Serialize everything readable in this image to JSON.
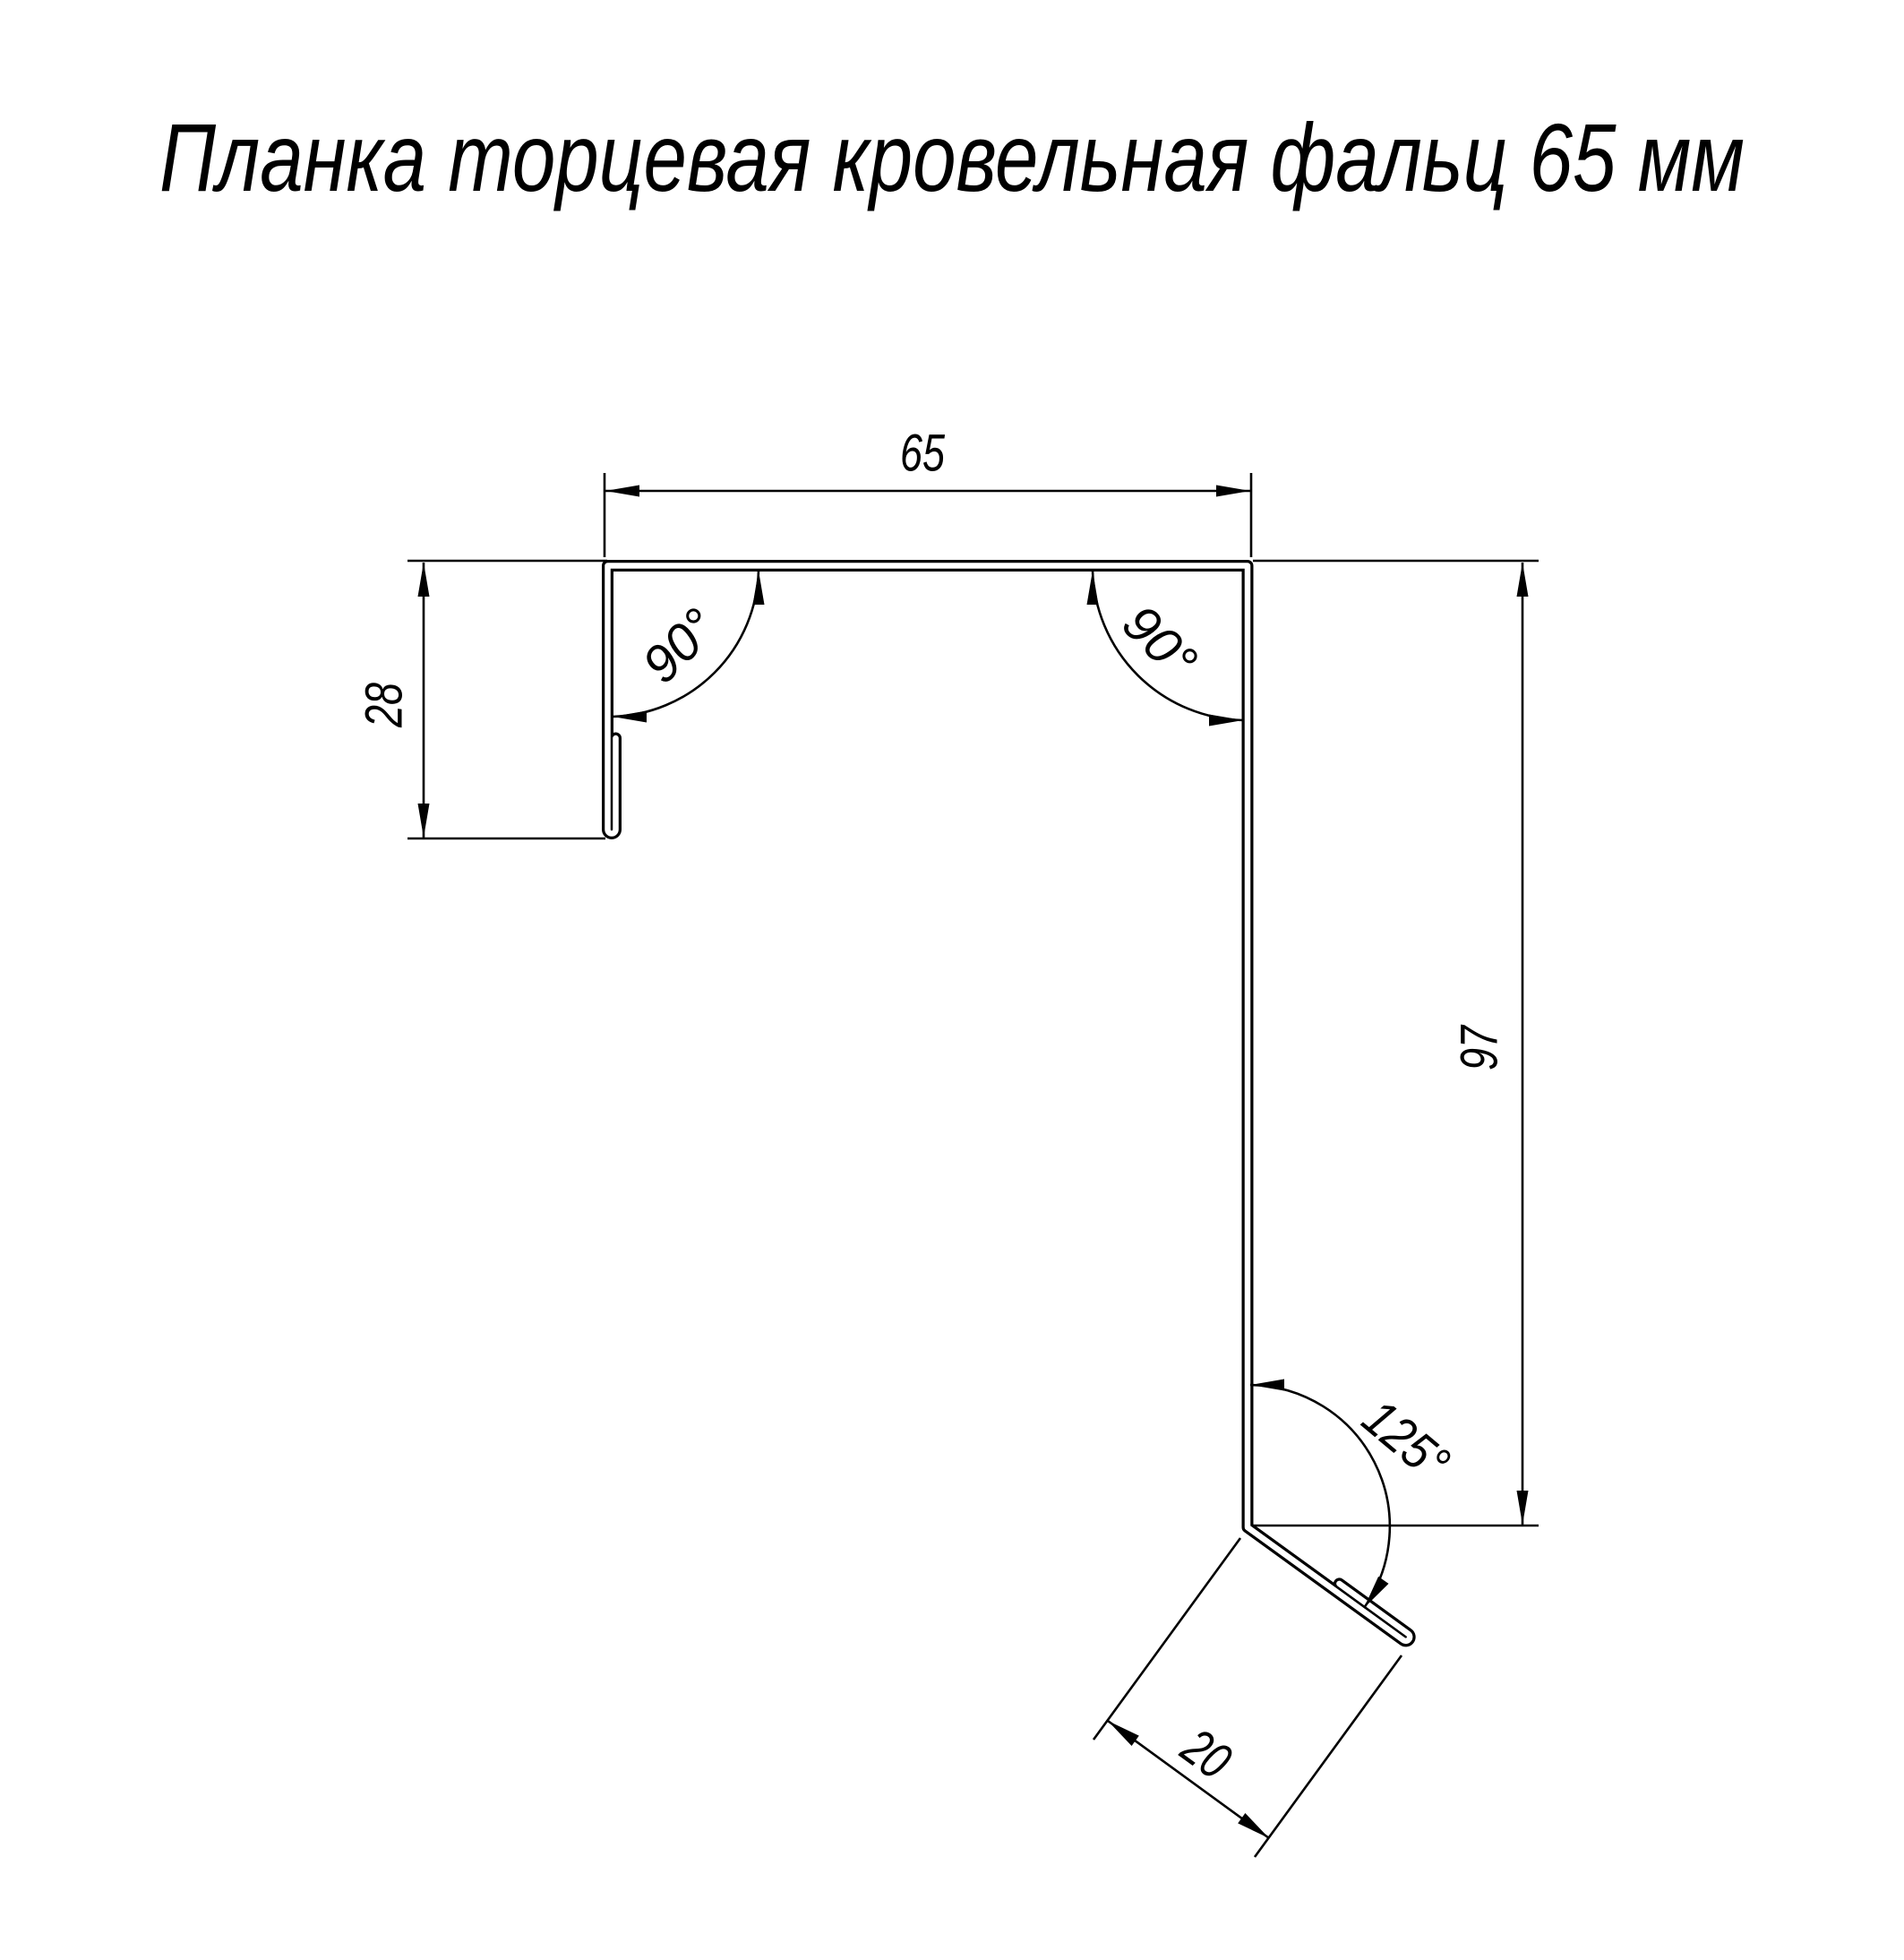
{
  "title": "Планка торцевая кровельная фальц 65 мм",
  "dimensions": {
    "width_top": "65",
    "height_left": "28",
    "height_right": "97",
    "flange_bottom": "20"
  },
  "angles": {
    "top_left": "90°",
    "top_right": "90°",
    "bottom_right": "125°"
  },
  "colors": {
    "line": "#000000",
    "background": "#ffffff"
  }
}
